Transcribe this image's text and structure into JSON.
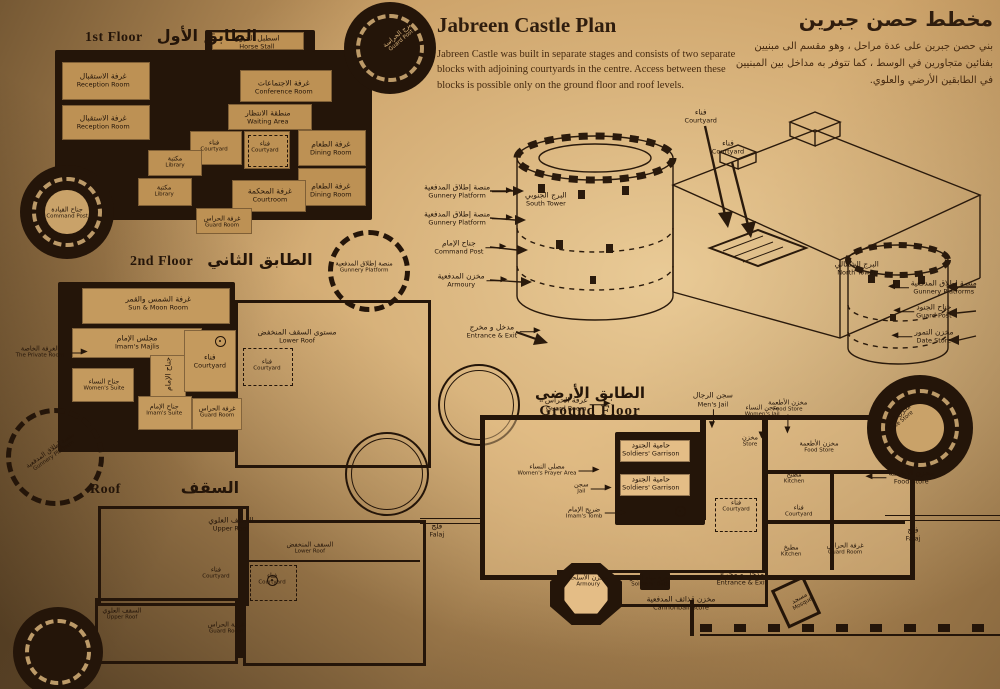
{
  "header": {
    "title_en": "Jabreen Castle Plan",
    "body_en": "Jabreen Castle was built in separate stages and consists of two separate blocks with adjoining courtyards in the centre. Access between these blocks is possible only on the ground floor and roof levels.",
    "title_ar": "مخطط حصن جبرين",
    "body_ar": "بني حصن جبرين على عدة مراحل ، وهو مقسم الى مبنيين بفنائين متجاورين في الوسط ، كما تتوفر به مداخل بين المبنيين في الطابقين الأرضي والعلوي."
  },
  "floor1": {
    "title_en": "1st Floor",
    "title_ar": "الطابق الأول",
    "labels": [
      {
        "ar": "اسطبل الخيول",
        "en": "Horse Stall",
        "x": 57.6,
        "y": 6.6
      },
      {
        "ar": "برج الحراسة",
        "en": "Guard Post",
        "x": 91.4,
        "y": 4.5,
        "r": -40,
        "c": "lt sm"
      },
      {
        "ar": "غرفة الاستقبال",
        "en": "Reception Room",
        "x": 21.0,
        "y": 24.5
      },
      {
        "ar": "غرفة الاجتماعات",
        "en": "Conference Room",
        "x": 64.0,
        "y": 27.8
      },
      {
        "ar": "غرفة الاستقبال",
        "en": "Reception Room",
        "x": 21.0,
        "y": 44.3
      },
      {
        "ar": "منطقة الانتظار",
        "en": "Waiting Area",
        "x": 60.2,
        "y": 42.0
      },
      {
        "ar": "فناء",
        "en": "Courtyard",
        "x": 47.4,
        "y": 55.7,
        "c": "sm"
      },
      {
        "ar": "فناء",
        "en": "Courtyard",
        "x": 59.5,
        "y": 56.1,
        "c": "sm"
      },
      {
        "ar": "غرفة الطعام",
        "en": "Dining Room",
        "x": 75.2,
        "y": 56.6
      },
      {
        "ar": "مكتبة",
        "en": "Library",
        "x": 38.1,
        "y": 63.2,
        "c": "sm"
      },
      {
        "ar": "مكتبة",
        "en": "Library",
        "x": 35.5,
        "y": 76.9,
        "c": "sm"
      },
      {
        "ar": "غرفة المحكمة",
        "en": "Courtroom",
        "x": 60.7,
        "y": 78.8
      },
      {
        "ar": "غرفة الطعام",
        "en": "Dining Room",
        "x": 75.2,
        "y": 76.4
      },
      {
        "ar": "غرفة الحراس",
        "en": "Guard Room",
        "x": 49.3,
        "y": 91.5,
        "c": "sm"
      },
      {
        "ar": "جناح القيادة",
        "en": "Command Post",
        "x": 12.4,
        "y": 87.3,
        "c": "sm"
      }
    ]
  },
  "floor2": {
    "title_en": "2nd Floor",
    "title_ar": "الطابق الثاني",
    "labels": [
      {
        "ar": "غرفة الشمس والقمر",
        "en": "Sun & Moon Room",
        "x": 33.3,
        "y": 26.8
      },
      {
        "ar": "مجلس الإمام",
        "en": "Imam's Majlis",
        "x": 28.4,
        "y": 43.4
      },
      {
        "ar": "الغرفة الخاصة",
        "en": "The Private Room",
        "x": 5.8,
        "y": 47.7,
        "c": "sm co-l"
      },
      {
        "ar": "جناح النساء",
        "en": "Women's Suite",
        "x": 20.7,
        "y": 61.7,
        "c": "sm"
      },
      {
        "ar": "جناح الإمام",
        "en": "",
        "x": 35.6,
        "y": 57.0,
        "r": -90
      },
      {
        "ar": "جناح الإمام",
        "en": "Imam's Suite",
        "x": 34.7,
        "y": 72.3,
        "c": "sm"
      },
      {
        "ar": "فناء",
        "en": "Courtyard",
        "x": 45.3,
        "y": 51.5
      },
      {
        "ar": "غرفة الحراس",
        "en": "Guard Room",
        "x": 47.0,
        "y": 73.2,
        "c": "sm"
      },
      {
        "ar": "مستوى السقف المنخفض",
        "en": "Lower Roof",
        "x": 65.6,
        "y": 40.9
      },
      {
        "ar": "فناء",
        "en": "Courtyard",
        "x": 58.6,
        "y": 53.2,
        "c": "sm"
      },
      {
        "ar": "منصة إطلاق المدفعية",
        "en": "Gunnery Platform",
        "x": 81.2,
        "y": 11.5,
        "c": "sm"
      },
      {
        "ar": "منصة إطلاق المدفعية",
        "en": "Gunnery Platform",
        "x": 8.6,
        "y": 90.6,
        "r": -35,
        "c": "sm"
      }
    ]
  },
  "roof": {
    "title_en": "Roof",
    "title_ar": "السقف",
    "labels": [
      {
        "ar": "السقف العلوي",
        "en": "Upper Roof",
        "x": 49.6,
        "y": 24.7
      },
      {
        "ar": "السقف المنخفض",
        "en": "Lower Roof",
        "x": 68.2,
        "y": 35.6,
        "c": "sm"
      },
      {
        "ar": "فناء",
        "en": "Courtyard",
        "x": 46.1,
        "y": 47.0,
        "c": "sm"
      },
      {
        "ar": "فناء",
        "en": "Courtyard",
        "x": 59.3,
        "y": 49.8,
        "c": "sm"
      },
      {
        "ar": "السقف العلوي",
        "en": "Upper Roof",
        "x": 24.0,
        "y": 65.8,
        "c": "sm"
      },
      {
        "ar": "غرفة الحراس",
        "en": "Guard Room",
        "x": 48.5,
        "y": 72.1,
        "c": "sm"
      }
    ]
  },
  "iso": {
    "labels": [
      {
        "ar": "منصة إطلاق المدفعية",
        "en": "Gunnery Platform",
        "x": 6.4,
        "y": 30.3,
        "c": "co-l"
      },
      {
        "ar": "منصة إطلاق المدفعية",
        "en": "Gunnery Platform",
        "x": 6.4,
        "y": 39.3,
        "c": "co-l"
      },
      {
        "ar": "جناح الإمام",
        "en": "Command Post",
        "x": 6.7,
        "y": 49.0,
        "c": "co-l"
      },
      {
        "ar": "مخزن المدفعية",
        "en": "Armoury",
        "x": 7.1,
        "y": 60.0,
        "c": "co-l"
      },
      {
        "ar": "البرج الجنوبي",
        "en": "South Tower",
        "x": 21.7,
        "y": 33.0
      },
      {
        "ar": "البرج الشمالي",
        "en": "North Tower",
        "x": 75.3,
        "y": 56.0
      },
      {
        "ar": "فناء",
        "en": "Courtyard",
        "x": 48.4,
        "y": 5.3
      },
      {
        "ar": "فناء",
        "en": "Courtyard",
        "x": 53.1,
        "y": 15.7
      },
      {
        "ar": "منصة إطلاق المدفعية",
        "en": "Gunnery Platforms",
        "x": 90.3,
        "y": 62.3,
        "c": "co-r"
      },
      {
        "ar": "جناح الجنود",
        "en": "Guard Post",
        "x": 88.6,
        "y": 70.3,
        "c": "co-r"
      },
      {
        "ar": "مخزن التمور",
        "en": "Date Store",
        "x": 88.6,
        "y": 78.7,
        "c": "co-r"
      },
      {
        "ar": "مدخل و مخرج",
        "en": "Entrance & Exit",
        "x": 12.4,
        "y": 77.0,
        "c": "co-l"
      }
    ]
  },
  "ground": {
    "title_en": "Ground Floor",
    "title_ar": "الطابق الأرضي",
    "labels": [
      {
        "ar": "غرفة الحراس",
        "en": "Guard Room",
        "x": 25.2,
        "y": 8.4,
        "c": "co-l"
      },
      {
        "ar": "سجن الرجال",
        "en": "Men's Jail",
        "x": 50.5,
        "y": 6.8,
        "c": "co-d"
      },
      {
        "ar": "سجن النساء",
        "en": "Women's Jail",
        "x": 59.0,
        "y": 10.6,
        "c": "sm co-d"
      },
      {
        "ar": "مخزن الأطعمة",
        "en": "Food Store",
        "x": 63.4,
        "y": 9.0,
        "c": "sm co-d"
      },
      {
        "ar": "مخزن",
        "en": "Store",
        "x": 56.9,
        "y": 20.3,
        "c": "sm"
      },
      {
        "ar": "حامية الجنود",
        "en": "Soldiers' Garrison",
        "x": 39.8,
        "y": 22.8
      },
      {
        "ar": "حامية الجنود",
        "en": "Soldiers' Garrison",
        "x": 39.8,
        "y": 33.8
      },
      {
        "ar": "مصلى النساء",
        "en": "Women's Prayer Area",
        "x": 21.9,
        "y": 29.6,
        "c": "sm co-l"
      },
      {
        "ar": "سجن",
        "en": "Jail",
        "x": 27.8,
        "y": 35.4,
        "c": "sm co-l"
      },
      {
        "ar": "ضريح الإمام",
        "en": "Imam's Tomb",
        "x": 28.3,
        "y": 43.4,
        "c": "sm co-l"
      },
      {
        "ar": "فناء",
        "en": "Courtyard",
        "x": 54.5,
        "y": 41.2,
        "c": "sm"
      },
      {
        "ar": "مطبخ",
        "en": "Kitchen",
        "x": 64.5,
        "y": 32.2,
        "c": "sm"
      },
      {
        "ar": "مخزن الأطعمة",
        "en": "Food Store",
        "x": 68.8,
        "y": 22.2,
        "c": "sm"
      },
      {
        "ar": "فناء",
        "en": "Courtyard",
        "x": 65.3,
        "y": 42.8,
        "c": "sm"
      },
      {
        "ar": "مطبخ",
        "en": "Kitchen",
        "x": 64.0,
        "y": 55.6,
        "c": "sm"
      },
      {
        "ar": "غرفة الحراس",
        "en": "Guard Room",
        "x": 73.3,
        "y": 55.0,
        "c": "sm"
      },
      {
        "ar": "مخزن الأطعمة",
        "en": "Food Store",
        "x": 84.7,
        "y": 31.8,
        "c": "co-r"
      },
      {
        "ar": "فلج",
        "en": "Falaj",
        "x": 85.0,
        "y": 50.2
      },
      {
        "ar": "مخزن التمور",
        "en": "Date Store",
        "x": 82.6,
        "y": 13.2,
        "r": -40,
        "c": "sm"
      },
      {
        "ar": "مخزن الأسلحة",
        "en": "Armoury",
        "x": 29.0,
        "y": 65.3,
        "c": "sm"
      },
      {
        "ar": "حجرة مياه الجنود",
        "en": "Soldiers' Bath",
        "x": 39.7,
        "y": 65.3,
        "c": "sm"
      },
      {
        "ar": "مخزن قذائف المدفعية",
        "en": "Cannonball Store",
        "x": 45.0,
        "y": 72.3
      },
      {
        "ar": "مدخل و مخرج",
        "en": "Entrance & Exit",
        "x": 55.5,
        "y": 64.3
      },
      {
        "ar": "مسجد",
        "en": "Mosque",
        "x": 65.7,
        "y": 71.7,
        "r": -30,
        "c": "sm"
      },
      {
        "ar": "فلج",
        "en": "Falaj",
        "x": 2.9,
        "y": 48.9
      }
    ]
  }
}
